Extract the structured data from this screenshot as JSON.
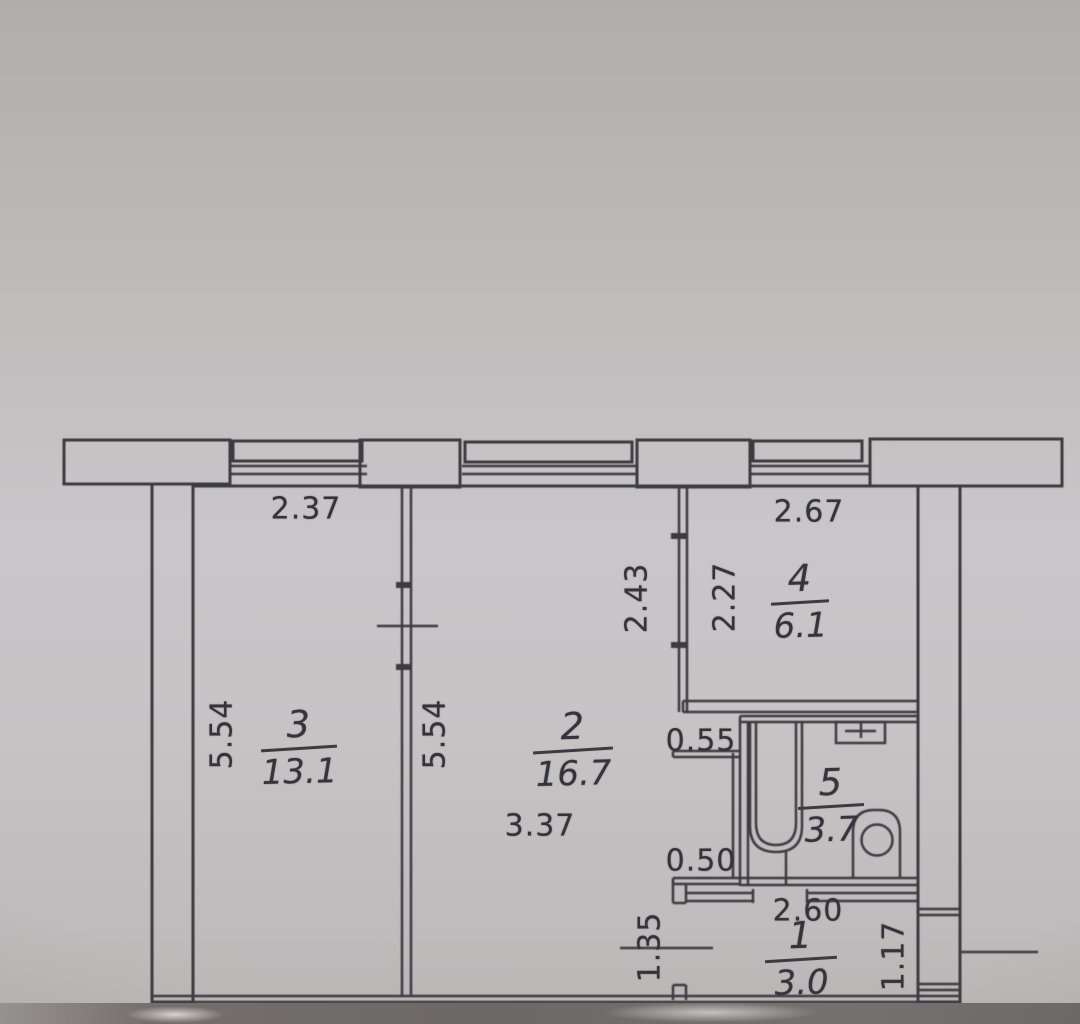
{
  "plan": {
    "kind": "apartment-floor-plan-scan",
    "rooms": [
      {
        "number": "3",
        "area": "13.1"
      },
      {
        "number": "2",
        "area": "16.7"
      },
      {
        "number": "4",
        "area": "6.1"
      },
      {
        "number": "5",
        "area": "3.7"
      },
      {
        "number": "1",
        "area": "3.0"
      }
    ],
    "dims": {
      "d237": "2.37",
      "d267": "2.67",
      "d243": "2.43",
      "d227": "2.27",
      "d554_left": "5.54",
      "d554_mid": "5.54",
      "d337": "3.37",
      "d055": "0.55",
      "d050": "0.50",
      "d260": "2.60",
      "d135": "1.35",
      "d117": "1.17"
    },
    "fixtures": {
      "bathtub": "bathtub",
      "toilet": "toilet",
      "sink": "sink"
    },
    "colors": {
      "ink": "#3c3b41",
      "paper": "#c6c3c5"
    }
  }
}
